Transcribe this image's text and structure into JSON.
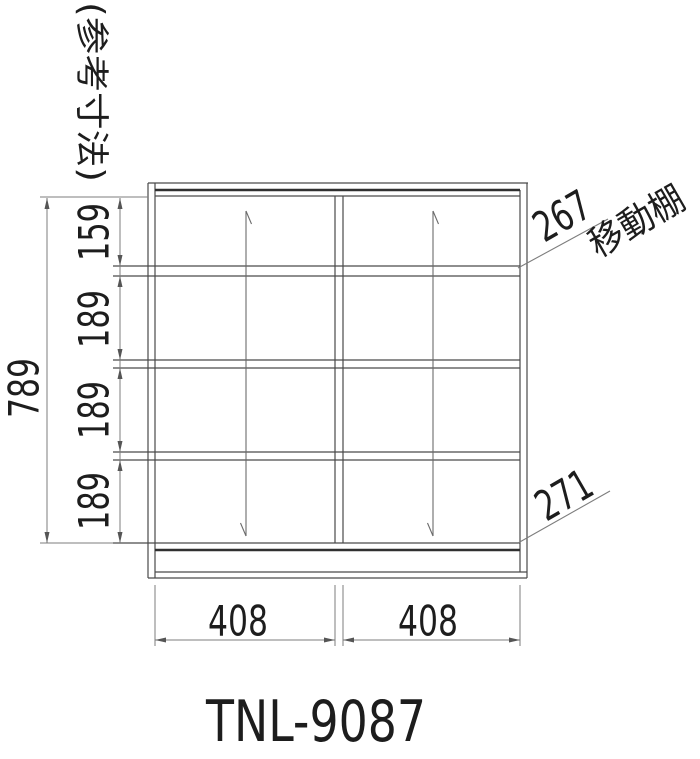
{
  "page": {
    "background": "#ffffff",
    "line_color": "#4a4a4a",
    "dim_line_color": "#7d7d7d",
    "text_color": "#1d1d1d"
  },
  "note": {
    "reference_dimensions": "(参考寸法)"
  },
  "dimensions": {
    "overall_height": "789",
    "sections": [
      "159",
      "189",
      "189",
      "189"
    ],
    "bottom_widths": [
      "408",
      "408"
    ],
    "top_shelf_depth": "267",
    "bottom_shelf_depth": "271"
  },
  "labels": {
    "movable_shelf": "移動棚",
    "model_number": "TNL-9087"
  }
}
